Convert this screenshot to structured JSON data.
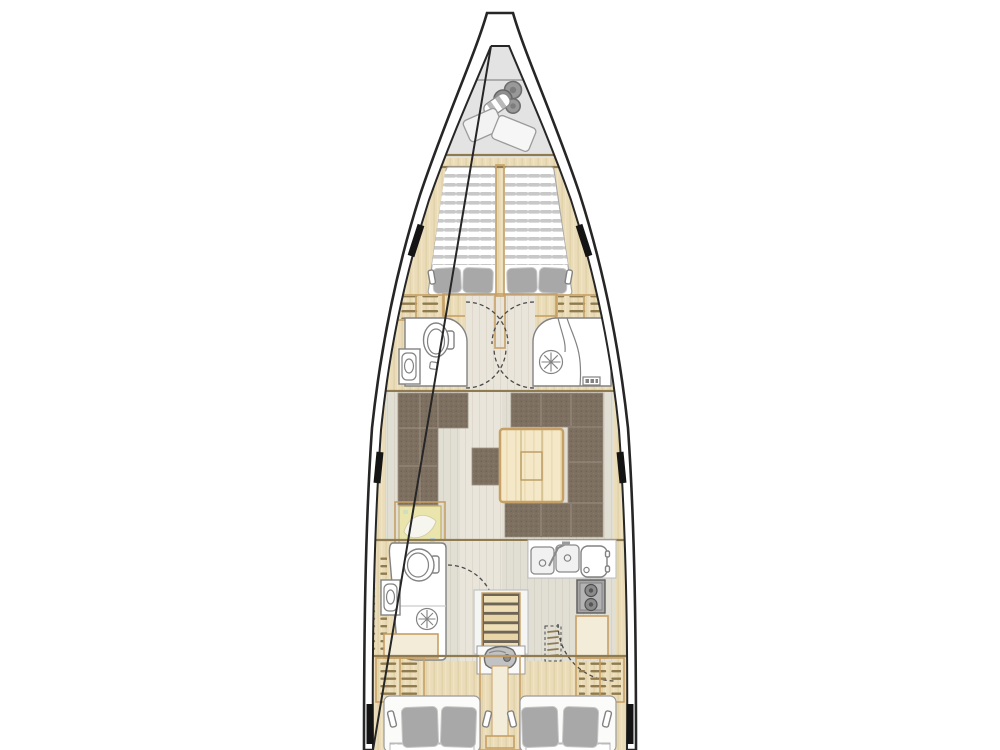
{
  "title": "sailing-yacht-interior-deck-plan",
  "colors": {
    "background": "#ffffff",
    "hull_outline": "#262626",
    "deck": "#ffffff",
    "locker": "#e3e3e3",
    "locker_line": "#9a9a9a",
    "wood": "#eadcb8",
    "wood_grain": "#dfcda1",
    "wood_trim": "#c7a065",
    "wood_dark_line": "#8f7b4f",
    "floor": "#e1ded4",
    "floor_grain": "#d6d2c6",
    "corridor": "#e9e5da",
    "corridor_grain": "#ddd8cb",
    "mattress": "#ffffff",
    "mattress_stripe": "#c8c8c8",
    "mattress_edge": "#a8a8a8",
    "pillow": "#a8a8a8",
    "pillow_edge": "#c6c6c6",
    "sofa": "#7d7060",
    "sofa_dot": "#6b5f51",
    "sofa_seam": "#9d9183",
    "table_wood": "#f4e8c8",
    "table_grain": "#e6d5a8",
    "fixture": "#ffffff",
    "fixture_line": "#828282",
    "appliance": "#a6a6a6",
    "appliance_dark": "#555555",
    "fender": "#999999",
    "fender_dark": "#6e6e6e",
    "map_paper": "#e9e5ad",
    "map_water": "#f7f6ee",
    "window": "#141414",
    "door_dash": "#4a4a4a",
    "engine": "#c2c2c2",
    "step_dark": "#6f6557",
    "step_light": "#eedfb7"
  },
  "regions": [
    "anchor-locker",
    "forward-cabin",
    "port-head",
    "starboard-shower-head",
    "saloon",
    "chart-table",
    "galley",
    "aft-head",
    "companionway",
    "port-aft-cabin",
    "starboard-aft-cabin"
  ],
  "furniture_icons": [
    "fender-icon",
    "sail-bag-icon",
    "v-berth-mattress",
    "pillow",
    "reading-lamp-icon",
    "locker-shelves",
    "toilet-icon",
    "sink-icon",
    "shower-drain-icon",
    "door-swing",
    "l-sofa",
    "u-sofa",
    "stool",
    "dinette-table",
    "nautical-chart-icon",
    "double-sink-icon",
    "fridge-icon",
    "stove-icon",
    "stairs-icon",
    "engine-icon",
    "hull-window",
    "double-bed-mattress"
  ]
}
